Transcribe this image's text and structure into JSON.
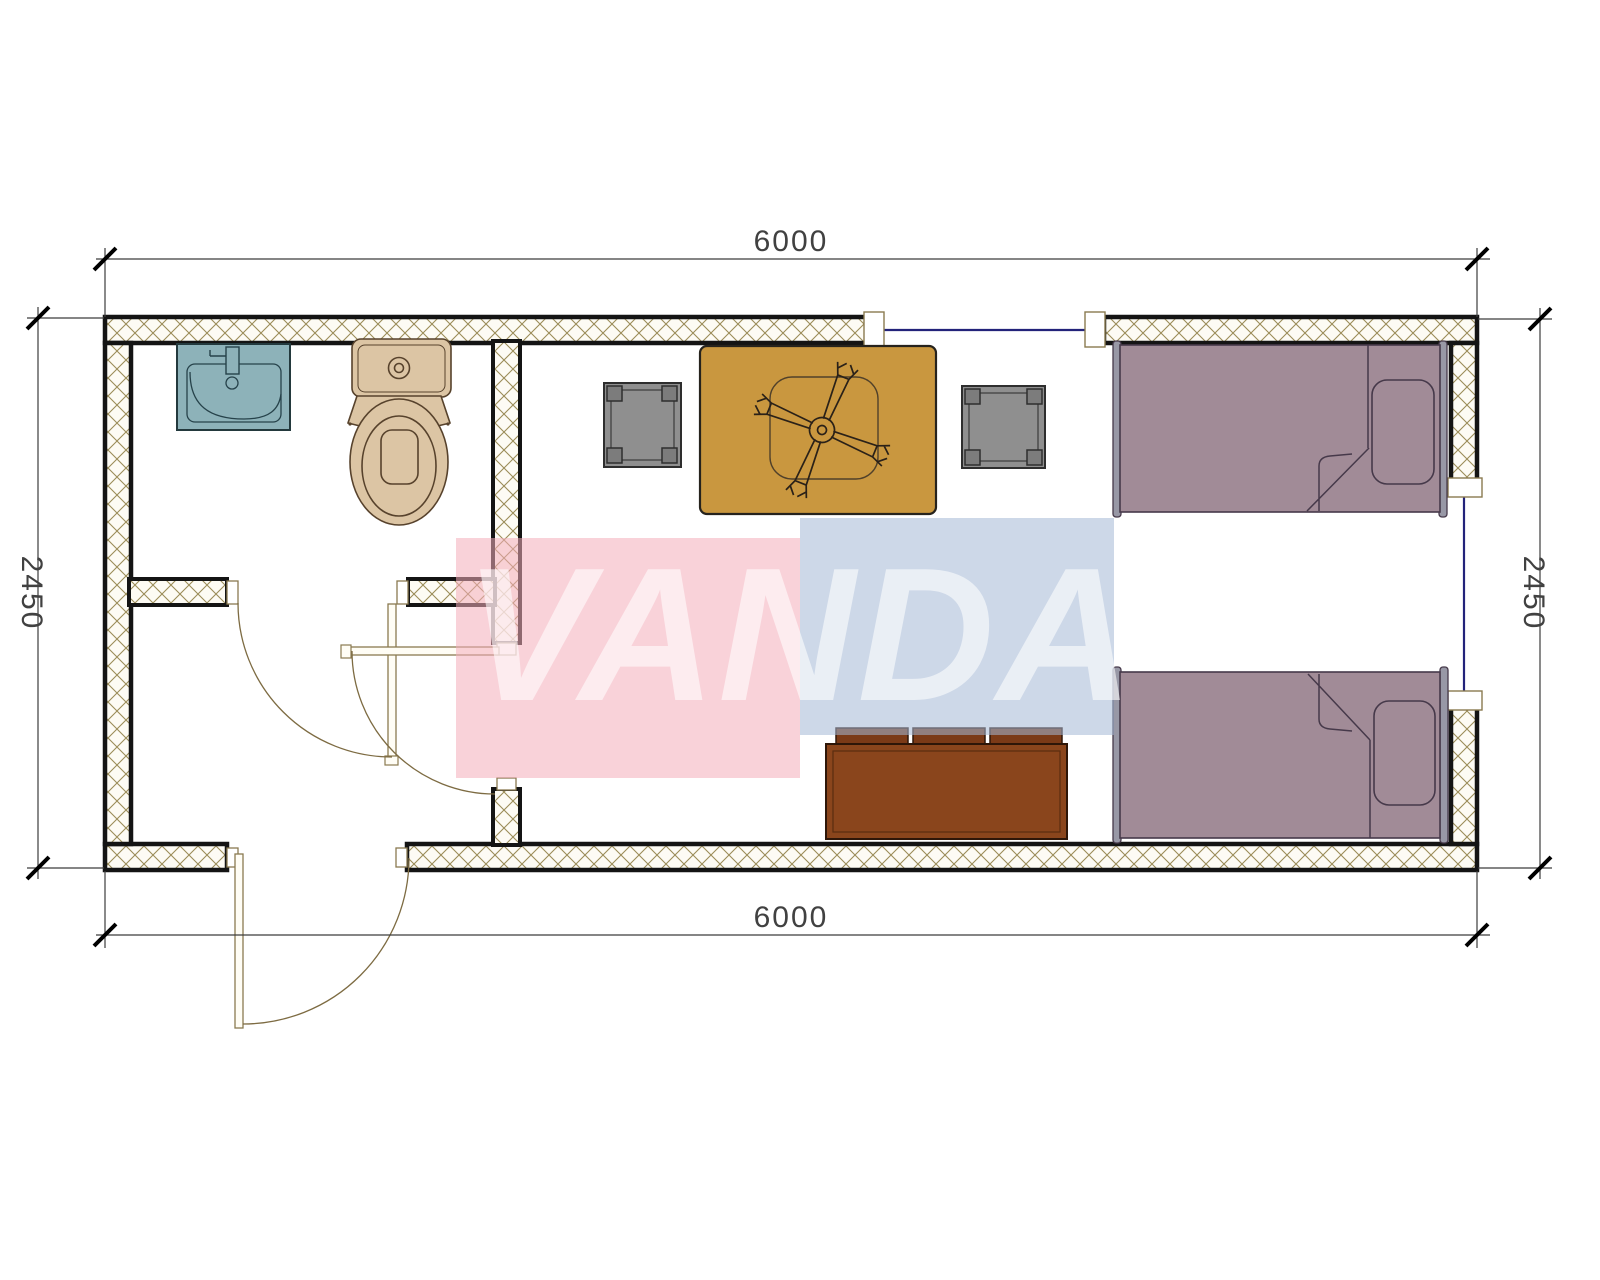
{
  "drawing": {
    "type": "floor-plan",
    "dimensions": {
      "top": "6000",
      "bottom": "6000",
      "left": "2450",
      "right": "2450"
    },
    "watermark": {
      "text": "VANDA"
    }
  },
  "colors": {
    "wall_hatch": "#9b8c58",
    "wall_fill": "#fdfbf4",
    "wall_face": "#141414",
    "window_line": "#23237a",
    "frame_outline": "#8a7a50",
    "door_arc": "#7d6b42",
    "table": "#c9973f",
    "table_detail": "#51412a",
    "stool": "#8f8f8f",
    "stool_corner": "#7c7c7c",
    "bed": "#a18b97",
    "bed_bar": "#9898a6",
    "bed_line": "#46394a",
    "bench": "#8a451c",
    "bench_cushion": "#7b3a17",
    "sink": "#8db2b9",
    "toilet": "#dcc5a4",
    "dim_line": "#3c3c3c",
    "dim_text": "#414141",
    "watermark_pink": "#f4adba",
    "watermark_blue": "#a4b8d5",
    "watermark_text": "#ffffff"
  }
}
